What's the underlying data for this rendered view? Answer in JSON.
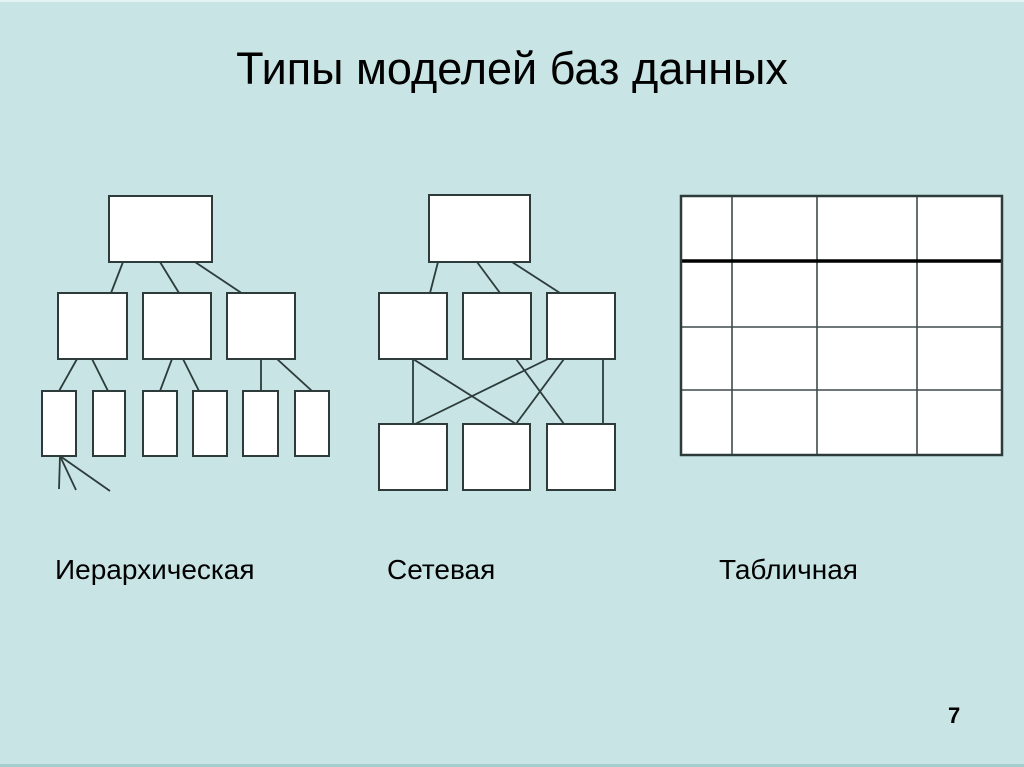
{
  "slide": {
    "title": "Типы моделей баз данных",
    "page_number": "7",
    "colors": {
      "background": "#c8e4e4",
      "line": "#2d3b3b",
      "box_fill": "#ffffff",
      "table_grid": "#3f4b4b",
      "table_header_line": "#000000",
      "edge_top": "#e3f2f2",
      "edge_bottom": "#a5cfcf"
    }
  },
  "diagrams": [
    {
      "id": "hierarchical",
      "label": "Иерархическая",
      "boxes": [
        [
          109,
          196,
          103,
          66
        ],
        [
          58,
          293,
          69,
          66
        ],
        [
          143,
          293,
          68,
          66
        ],
        [
          227,
          293,
          68,
          66
        ],
        [
          42,
          391,
          34,
          65
        ],
        [
          93,
          391,
          32,
          65
        ],
        [
          143,
          391,
          34,
          65
        ],
        [
          193,
          391,
          34,
          65
        ],
        [
          243,
          391,
          35,
          65
        ],
        [
          295,
          391,
          34,
          65
        ]
      ],
      "lines": [
        [
          123,
          262,
          111,
          293
        ],
        [
          160,
          262,
          179,
          293
        ],
        [
          195,
          262,
          243,
          294
        ],
        [
          77,
          359,
          59,
          391
        ],
        [
          92,
          359,
          108,
          391
        ],
        [
          172,
          359,
          160,
          391
        ],
        [
          183,
          359,
          199,
          391
        ],
        [
          261,
          359,
          261,
          391
        ],
        [
          277,
          359,
          312,
          391
        ],
        [
          60,
          456,
          59,
          489
        ],
        [
          60,
          456,
          76,
          490
        ],
        [
          60,
          456,
          110,
          491
        ]
      ]
    },
    {
      "id": "network",
      "label": "Сетевая",
      "boxes": [
        [
          429,
          195,
          101,
          67
        ],
        [
          379,
          293,
          68,
          66
        ],
        [
          463,
          293,
          68,
          66
        ],
        [
          547,
          293,
          68,
          66
        ],
        [
          379,
          424,
          68,
          66
        ],
        [
          463,
          424,
          67,
          66
        ],
        [
          547,
          424,
          68,
          66
        ]
      ],
      "lines": [
        [
          438,
          262,
          430,
          293
        ],
        [
          477,
          262,
          500,
          293
        ],
        [
          512,
          262,
          560,
          293
        ],
        [
          413,
          359,
          413,
          424
        ],
        [
          413,
          359,
          516,
          424
        ],
        [
          516,
          359,
          564,
          424
        ],
        [
          564,
          359,
          516,
          424
        ],
        [
          548,
          359,
          415,
          424
        ],
        [
          603,
          359,
          603,
          424
        ]
      ]
    },
    {
      "id": "table",
      "label": "Табличная",
      "table": {
        "col_edges": [
          681,
          732,
          817,
          917,
          1002
        ],
        "row_edges": [
          196,
          261,
          327,
          390,
          455
        ],
        "bold_row_edge_index": 1
      }
    }
  ]
}
